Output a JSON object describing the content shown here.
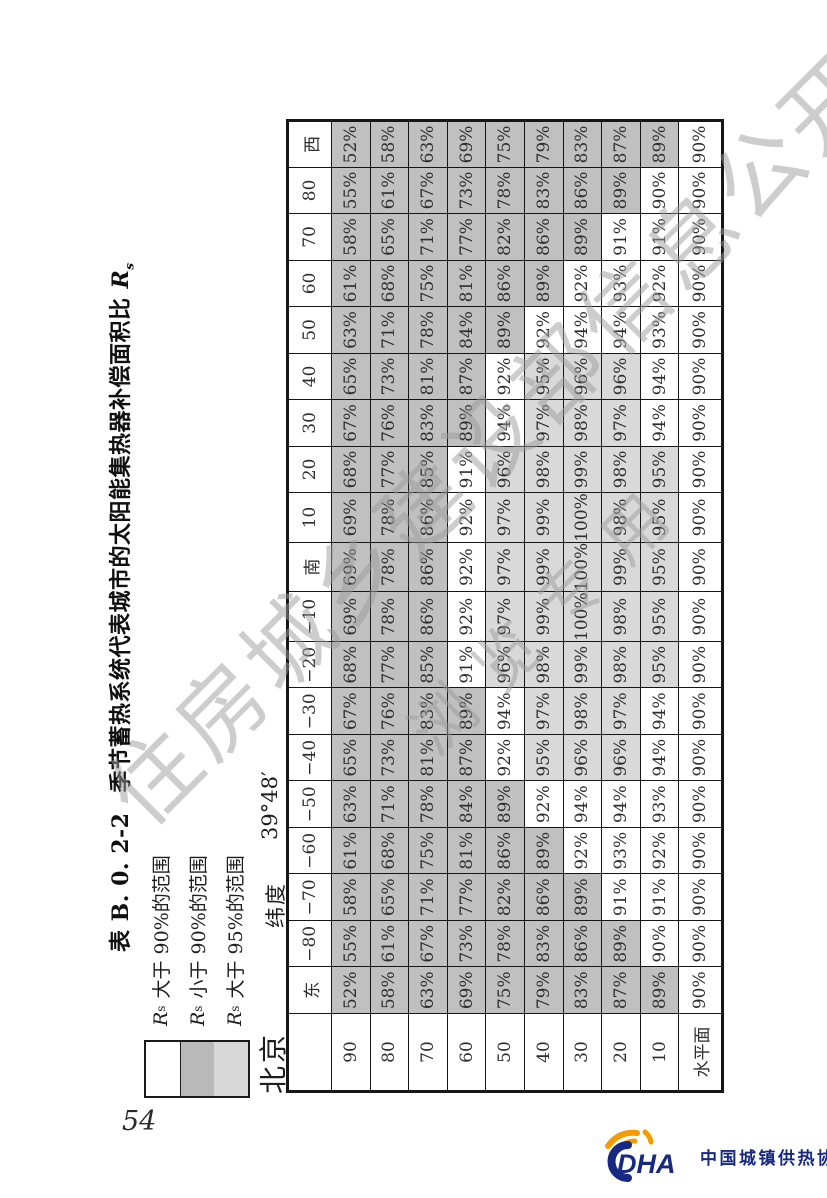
{
  "page": {
    "number": "54"
  },
  "title": {
    "table_no": "表 B. 0. 2-2",
    "text": "季节蓄热系统代表城市的太阳能集热器补偿面积比",
    "symbol_base": "R",
    "symbol_sub": "s"
  },
  "legend": {
    "items": [
      {
        "rs_base": "R",
        "rs_sub": "s",
        "label": "大于 90%的范围",
        "swatch_color": "#ffffff"
      },
      {
        "rs_base": "R",
        "rs_sub": "s",
        "label": "小于 90%的范围",
        "swatch_color": "#b9b9b9"
      },
      {
        "rs_base": "R",
        "rs_sub": "s",
        "label": "大于 95%的范围",
        "swatch_color": "#d8d8d8"
      }
    ]
  },
  "location": {
    "city": "北京",
    "latitude_label": "纬度",
    "latitude_value": "39°48′"
  },
  "table": {
    "corner": "",
    "col_headers": [
      "东",
      "−80",
      "−70",
      "−60",
      "−50",
      "−40",
      "−30",
      "−20",
      "−10",
      "南",
      "10",
      "20",
      "30",
      "40",
      "50",
      "60",
      "70",
      "80",
      "西"
    ],
    "row_headers": [
      "90",
      "80",
      "70",
      "60",
      "50",
      "40",
      "30",
      "20",
      "10",
      "水平面"
    ],
    "value_suffix": "%",
    "rows": [
      [
        52,
        55,
        58,
        61,
        63,
        65,
        67,
        68,
        69,
        69,
        69,
        68,
        67,
        65,
        63,
        61,
        58,
        55,
        52
      ],
      [
        58,
        61,
        65,
        68,
        71,
        73,
        76,
        77,
        78,
        78,
        78,
        77,
        76,
        73,
        71,
        68,
        65,
        61,
        58
      ],
      [
        63,
        67,
        71,
        75,
        78,
        81,
        83,
        85,
        86,
        86,
        86,
        85,
        83,
        81,
        78,
        75,
        71,
        67,
        63
      ],
      [
        69,
        73,
        77,
        81,
        84,
        87,
        89,
        91,
        92,
        92,
        92,
        91,
        89,
        87,
        84,
        81,
        77,
        73,
        69
      ],
      [
        75,
        78,
        82,
        86,
        89,
        92,
        94,
        96,
        97,
        97,
        97,
        96,
        94,
        92,
        89,
        86,
        82,
        78,
        75
      ],
      [
        79,
        83,
        86,
        89,
        92,
        95,
        97,
        98,
        99,
        99,
        99,
        98,
        97,
        95,
        92,
        89,
        86,
        83,
        79
      ],
      [
        83,
        86,
        89,
        92,
        94,
        96,
        98,
        99,
        100,
        100,
        100,
        99,
        98,
        96,
        94,
        92,
        89,
        86,
        83
      ],
      [
        87,
        89,
        91,
        93,
        94,
        96,
        97,
        98,
        98,
        99,
        98,
        98,
        97,
        96,
        94,
        93,
        91,
        89,
        87
      ],
      [
        89,
        90,
        91,
        92,
        93,
        94,
        94,
        95,
        95,
        95,
        95,
        95,
        94,
        94,
        93,
        92,
        91,
        90,
        89
      ],
      [
        90,
        90,
        90,
        90,
        90,
        90,
        90,
        90,
        90,
        90,
        90,
        90,
        90,
        90,
        90,
        90,
        90,
        90,
        90
      ]
    ],
    "shading_rule": {
      "below_90": "#c0c0c0",
      "90_to_94": "#ffffff",
      "95_and_above": "#d9d9d9"
    }
  },
  "watermark": {
    "line1": "住房城乡建设部信息公开",
    "line2": "浏览专用"
  },
  "footer_logo": {
    "acronym": "DHA",
    "name": "中国城镇供热协会",
    "navy": "#172983",
    "orange": "#f59b00"
  }
}
